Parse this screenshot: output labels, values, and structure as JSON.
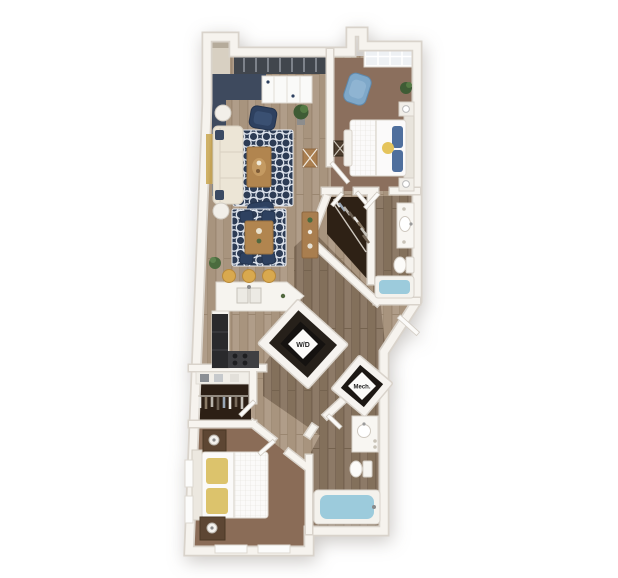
{
  "labels": {
    "washer_dryer": "W/D",
    "mechanical": "Mech."
  },
  "colors": {
    "background": "#ffffff",
    "wall": "#f6f3ee",
    "wall_shadow": "#d9d3cb",
    "wood_floor": "#b09d89",
    "wood_floor_dark": "#8d7a67",
    "carpet_bedroom1": "#8b6f5d",
    "carpet_bedroom2": "#8a6c57",
    "accent_wall_navy": "#3e4a5e",
    "window_glass_dark": "#41464d",
    "rug_navy": "#2d3c55",
    "sofa_cream": "#ece5d6",
    "armchair_navy": "#2e4160",
    "armchair_blue": "#7fa8c9",
    "pillow_blue": "#4f6f9d",
    "pillow_yellow": "#dcc36c",
    "stool_yellow": "#d9a94e",
    "wood_furniture": "#b1854f",
    "tub_water": "#9ccbdc",
    "appliance_black": "#2a2a2c",
    "closet_interior": "#2c2015",
    "label_plate": "#fcfbf9",
    "label_text": "#222222"
  }
}
